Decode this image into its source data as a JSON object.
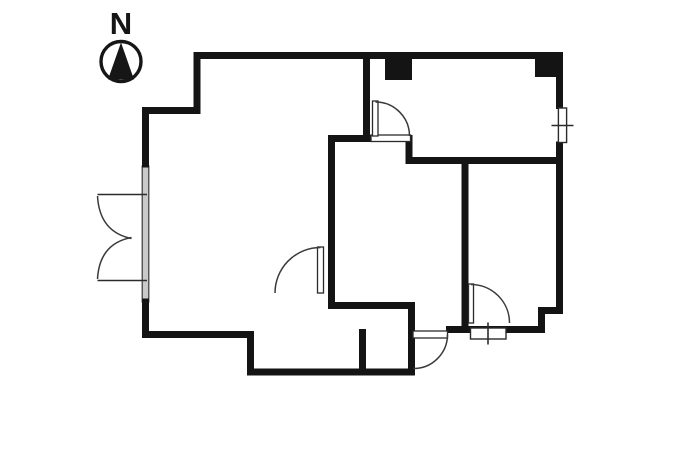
{
  "compass": {
    "label": "N"
  },
  "canvas": {
    "width": 700,
    "height": 467,
    "background": "#ffffff"
  },
  "palette": {
    "wall": "#141414",
    "thin_line": "#2b2b2b",
    "glass_fill": "#c9c9c9",
    "background": "#ffffff"
  },
  "plan": {
    "elements": [
      {
        "tag": "line",
        "name": "wall-outer-top",
        "cls": "wall",
        "attrs": {
          "x1": 193.5,
          "y1": 55.5,
          "x2": 563,
          "y2": 55.5
        }
      },
      {
        "tag": "line",
        "name": "wall-outer-right-upper",
        "cls": "wall",
        "attrs": {
          "x1": 559.5,
          "y1": 52,
          "x2": 559.5,
          "y2": 109
        }
      },
      {
        "tag": "line",
        "name": "wall-outer-right-lower",
        "cls": "wall",
        "attrs": {
          "x1": 559.5,
          "y1": 141.5,
          "x2": 559.5,
          "y2": 314
        }
      },
      {
        "tag": "line",
        "name": "wall-notch-top",
        "cls": "wall",
        "attrs": {
          "x1": 563,
          "y1": 310.5,
          "x2": 538,
          "y2": 310.5
        }
      },
      {
        "tag": "line",
        "name": "wall-notch-side",
        "cls": "wall",
        "attrs": {
          "x1": 541.5,
          "y1": 307,
          "x2": 541.5,
          "y2": 333
        }
      },
      {
        "tag": "line",
        "name": "wall-south-entry",
        "cls": "wall",
        "attrs": {
          "x1": 545,
          "y1": 329.5,
          "x2": 446,
          "y2": 329.5
        }
      },
      {
        "tag": "line",
        "name": "wall-entry-west",
        "cls": "wall",
        "attrs": {
          "x1": 411.5,
          "y1": 302,
          "x2": 411.5,
          "y2": 375.5
        }
      },
      {
        "tag": "line",
        "name": "wall-outer-bottom",
        "cls": "wall",
        "attrs": {
          "x1": 415,
          "y1": 372,
          "x2": 247,
          "y2": 372
        }
      },
      {
        "tag": "line",
        "name": "wall-bottom-step",
        "cls": "wall",
        "attrs": {
          "x1": 250.5,
          "y1": 375.5,
          "x2": 250.5,
          "y2": 331
        }
      },
      {
        "tag": "line",
        "name": "wall-living-south",
        "cls": "wall",
        "attrs": {
          "x1": 254,
          "y1": 334.5,
          "x2": 142,
          "y2": 334.5
        }
      },
      {
        "tag": "line",
        "name": "wall-left-lower",
        "cls": "wall",
        "attrs": {
          "x1": 145.5,
          "y1": 338,
          "x2": 145.5,
          "y2": 301
        }
      },
      {
        "tag": "line",
        "name": "wall-left-upper",
        "cls": "wall",
        "attrs": {
          "x1": 145.5,
          "y1": 167,
          "x2": 145.5,
          "y2": 107
        }
      },
      {
        "tag": "line",
        "name": "wall-step-top",
        "cls": "wall",
        "attrs": {
          "x1": 142,
          "y1": 110.5,
          "x2": 200.5,
          "y2": 110.5
        }
      },
      {
        "tag": "line",
        "name": "wall-step-side",
        "cls": "wall",
        "attrs": {
          "x1": 197,
          "y1": 114,
          "x2": 197,
          "y2": 52
        }
      },
      {
        "tag": "line",
        "name": "wall-bedroom-west",
        "cls": "wall",
        "attrs": {
          "x1": 366.5,
          "y1": 52,
          "x2": 366.5,
          "y2": 140
        }
      },
      {
        "tag": "line",
        "name": "wall-mid-north",
        "cls": "wall",
        "attrs": {
          "x1": 328,
          "y1": 138.5,
          "x2": 372.5,
          "y2": 138.5
        }
      },
      {
        "tag": "line",
        "name": "wall-mid-step",
        "cls": "wall",
        "attrs": {
          "x1": 409,
          "y1": 135,
          "x2": 409,
          "y2": 164
        }
      },
      {
        "tag": "line",
        "name": "wall-bedroom-south",
        "cls": "wall",
        "attrs": {
          "x1": 405.5,
          "y1": 160.5,
          "x2": 563,
          "y2": 160.5
        }
      },
      {
        "tag": "line",
        "name": "wall-mid-west",
        "cls": "wall",
        "attrs": {
          "x1": 331.5,
          "y1": 135,
          "x2": 331.5,
          "y2": 309
        }
      },
      {
        "tag": "line",
        "name": "wall-mid-south",
        "cls": "wall",
        "attrs": {
          "x1": 328,
          "y1": 305.5,
          "x2": 415,
          "y2": 305.5
        }
      },
      {
        "tag": "line",
        "name": "wall-east-room-west",
        "cls": "wall",
        "attrs": {
          "x1": 465,
          "y1": 157,
          "x2": 465,
          "y2": 333
        }
      },
      {
        "tag": "line",
        "name": "wall-toilet-stub",
        "cls": "wall",
        "attrs": {
          "x1": 362.5,
          "y1": 329,
          "x2": 362.5,
          "y2": 375
        }
      },
      {
        "tag": "rect",
        "name": "pillar-bedroom-left",
        "cls": "pillar",
        "attrs": {
          "x": 385,
          "y": 56,
          "width": 27,
          "height": 24
        }
      },
      {
        "tag": "rect",
        "name": "pillar-bedroom-right",
        "cls": "pillar",
        "attrs": {
          "x": 535,
          "y": 56,
          "width": 23,
          "height": 21
        }
      },
      {
        "tag": "rect",
        "name": "glass-door-panel",
        "cls": "glass",
        "attrs": {
          "x": 142.2,
          "y": 166,
          "width": 6.6,
          "height": 136
        }
      },
      {
        "tag": "rect",
        "name": "glass-cap-top",
        "cls": "pillar",
        "attrs": {
          "x": 142,
          "y": 163.5,
          "width": 7,
          "height": 4
        }
      },
      {
        "tag": "rect",
        "name": "glass-cap-bottom",
        "cls": "pillar",
        "attrs": {
          "x": 142,
          "y": 298.5,
          "width": 7,
          "height": 4
        }
      },
      {
        "tag": "rect",
        "name": "threshold-bedroom-door",
        "cls": "threshold",
        "attrs": {
          "x": 371,
          "y": 135,
          "width": 39.5,
          "height": 6.5
        }
      },
      {
        "tag": "rect",
        "name": "door-leaf-entrance",
        "cls": "threshold",
        "attrs": {
          "x": 413,
          "y": 331,
          "width": 34.5,
          "height": 7
        }
      },
      {
        "tag": "rect",
        "name": "door-leaf-bedroom",
        "cls": "threshold",
        "attrs": {
          "x": 372.5,
          "y": 101,
          "width": 5.5,
          "height": 35
        }
      },
      {
        "tag": "rect",
        "name": "door-leaf-mid-west",
        "cls": "threshold",
        "attrs": {
          "x": 317.5,
          "y": 247,
          "width": 6,
          "height": 46
        }
      },
      {
        "tag": "rect",
        "name": "door-leaf-east-room",
        "cls": "threshold",
        "attrs": {
          "x": 468.5,
          "y": 284,
          "width": 5,
          "height": 39
        }
      },
      {
        "tag": "rect",
        "name": "window-right",
        "cls": "win",
        "attrs": {
          "x": 558.4,
          "y": 108,
          "width": 8.2,
          "height": 34.5
        }
      },
      {
        "tag": "rect",
        "name": "window-south",
        "cls": "win",
        "attrs": {
          "x": 470.5,
          "y": 328,
          "width": 35.5,
          "height": 11
        }
      },
      {
        "tag": "line",
        "name": "window-right-tick",
        "cls": "thin",
        "attrs": {
          "x1": 551.5,
          "y1": 125.5,
          "x2": 573.5,
          "y2": 125.5
        }
      },
      {
        "tag": "line",
        "name": "window-south-tick",
        "cls": "thin",
        "attrs": {
          "x1": 488,
          "y1": 322.5,
          "x2": 488,
          "y2": 344.5
        }
      },
      {
        "tag": "path",
        "name": "door-arc-bedroom",
        "cls": "arc",
        "attrs": {
          "d": "M 375.5 102 A 34 34 0 0 1 409.5 136"
        }
      },
      {
        "tag": "path",
        "name": "door-arc-mid-west",
        "cls": "arc",
        "attrs": {
          "d": "M 320.5 247.5 A 45.5 45.5 0 0 0 275 293"
        }
      },
      {
        "tag": "path",
        "name": "door-arc-east-room",
        "cls": "arc",
        "attrs": {
          "d": "M 471 284.5 A 38.5 38.5 0 0 1 509.5 323"
        }
      },
      {
        "tag": "path",
        "name": "door-arc-entrance",
        "cls": "arc",
        "attrs": {
          "d": "M 447.5 334.5 A 34 34 0 0 1 413.5 368.5"
        }
      },
      {
        "tag": "line",
        "name": "balcony-door-leaf-top",
        "cls": "thin",
        "attrs": {
          "x1": 97.5,
          "y1": 194.5,
          "x2": 147,
          "y2": 194.5
        }
      },
      {
        "tag": "line",
        "name": "balcony-door-leaf-bottom",
        "cls": "thin",
        "attrs": {
          "x1": 97.5,
          "y1": 280.5,
          "x2": 147,
          "y2": 280.5
        }
      },
      {
        "tag": "path",
        "name": "balcony-door-arc-top",
        "cls": "arc",
        "attrs": {
          "d": "M 97.5 196 Q 99.5 232 131.5 238.5"
        }
      },
      {
        "tag": "path",
        "name": "balcony-door-arc-bottom",
        "cls": "arc",
        "attrs": {
          "d": "M 97.5 279 Q 99.5 243.5 131.5 237.5"
        }
      },
      {
        "tag": "circle",
        "name": "compass-circle",
        "cls": "compass-ring",
        "attrs": {
          "cx": 121,
          "cy": 61.5,
          "r": 20
        }
      },
      {
        "tag": "polygon",
        "name": "north-needle-icon",
        "cls": "needle",
        "attrs": {
          "points": "121,42.5 108,79.5 134,79.5"
        }
      }
    ]
  }
}
